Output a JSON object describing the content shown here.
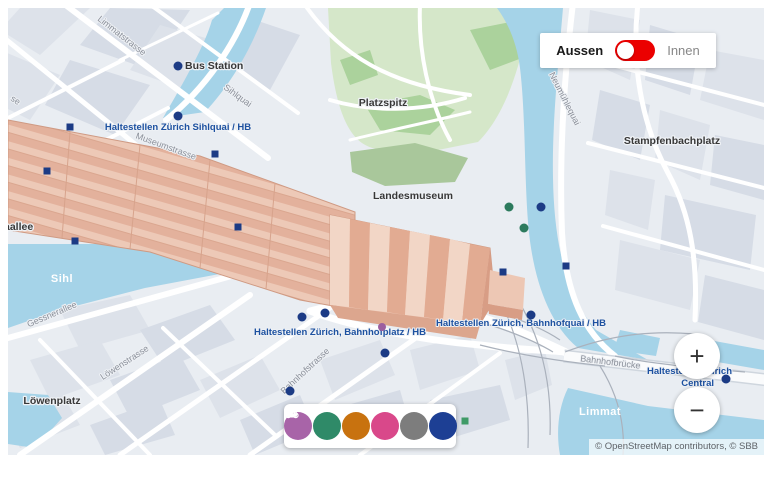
{
  "view_toggle": {
    "label_outdoor": "Aussen",
    "label_indoor": "Innen"
  },
  "zoom_controls": {
    "zoom_in": "+",
    "zoom_out": "−"
  },
  "attribution": "© OpenStreetMap contributors, © SBB",
  "colors": {
    "toggle_active": "#eb0000",
    "transit_label": "#1d51a0",
    "station_roof": "#e9bca6",
    "water": "#a5d3e8",
    "park": "#d5e7c9"
  },
  "filter_bar": {
    "buttons": [
      {
        "name": "services",
        "color": "#a864a8"
      },
      {
        "name": "mobility",
        "color": "#2f8a68"
      },
      {
        "name": "restaurants",
        "color": "#c8720f"
      },
      {
        "name": "shopping",
        "color": "#d9488a"
      },
      {
        "name": "lockers",
        "color": "#7d7d7d"
      },
      {
        "name": "elevators",
        "color": "#1d3f94"
      }
    ]
  },
  "labels": {
    "places": {
      "bus_station": "Bus Station",
      "platzspitz": "Platzspitz",
      "landesmuseum": "Landesmuseum",
      "stampfenbachplatz": "Stampfenbachplatz",
      "loewenplatz": "Löwenplatz",
      "europaallee_partial": "aallee"
    },
    "streets": {
      "limmatstrasse": "Limmatstrasse",
      "sihlquai": "Sihlquai",
      "museumstrasse": "Museumstrasse",
      "neumuehlequai": "Neumühlequai",
      "gessnerallee": "Gessnerallee",
      "loewenstrasse": "Löwenstrasse",
      "bahnhofstrasse": "Bahnhofstrasse",
      "bahnhofbruecke": "Bahnhofbrücke",
      "edge_partial": "se"
    },
    "waters": {
      "sihl": "Sihl",
      "limmat": "Limmat"
    },
    "transit_stops": {
      "sihlquai_hb": "Haltestellen Zürich Sihlquai / HB",
      "bahnhofplatz_hb": "Haltestellen Zürich, Bahnhofplatz / HB",
      "bahnhofquai_hb": "Haltestellen Zürich, Bahnhofquai / HB",
      "central_line1": "Haltestellen Zürich",
      "central_line2": "Central"
    }
  }
}
